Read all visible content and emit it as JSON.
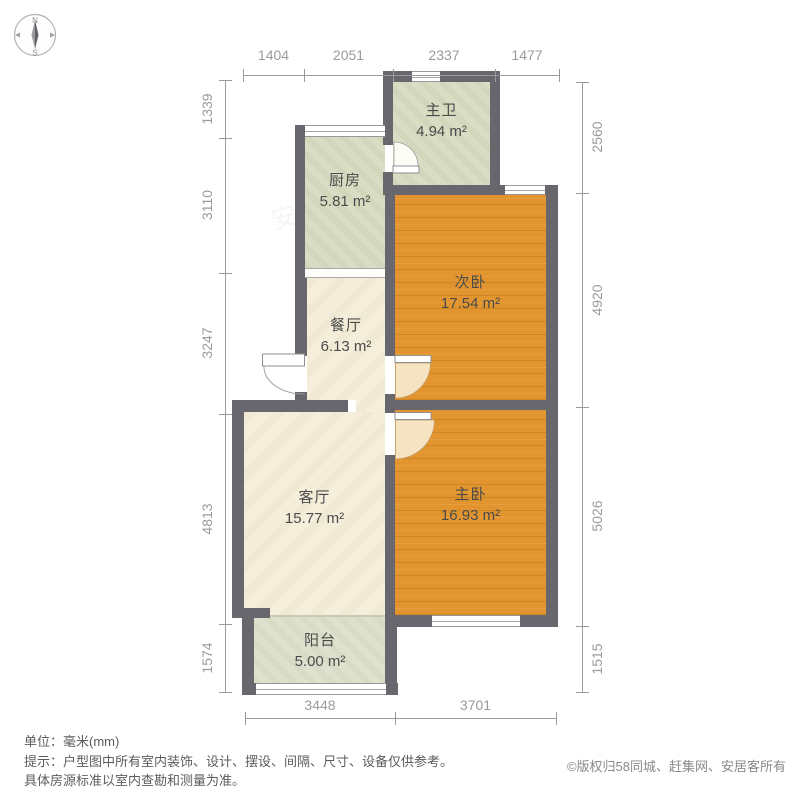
{
  "compass": {
    "north": "N",
    "south": "S"
  },
  "rooms": {
    "master_bath": {
      "name": "主卫",
      "area": "4.94 m²"
    },
    "kitchen": {
      "name": "厨房",
      "area": "5.81 m²"
    },
    "second_bedroom": {
      "name": "次卧",
      "area": "17.54 m²"
    },
    "dining": {
      "name": "餐厅",
      "area": "6.13 m²"
    },
    "living": {
      "name": "客厅",
      "area": "15.77 m²"
    },
    "master_bedroom": {
      "name": "主卧",
      "area": "16.93 m²"
    },
    "balcony": {
      "name": "阳台",
      "area": "5.00 m²"
    }
  },
  "dimensions": {
    "unit": "mm",
    "top": [
      "1404",
      "2051",
      "2337",
      "1477"
    ],
    "left": [
      "1339",
      "3110",
      "3247",
      "4813",
      "1574"
    ],
    "right": [
      "2560",
      "4920",
      "5026",
      "1515"
    ],
    "bottom": [
      "3448",
      "3701"
    ]
  },
  "footer": {
    "unit_note": "单位：毫米(mm)",
    "tip_line1": "提示：户型图中所有室内装饰、设计、摆设、间隔、尺寸、设备仅供参考。",
    "tip_line2": "具体房源标准以室内查勘和测量为准。",
    "copyright": "©版权归58同城、赶集网、安居客所有"
  },
  "watermark": {
    "text1": "安居客",
    "text2": "58同城"
  },
  "colors": {
    "wall": "#67676d",
    "tile_floor": "#d9ddc3",
    "cream_floor": "#f4eedb",
    "bedroom_floor": "#e2952e",
    "balcony_floor": "#dde1ce",
    "dim_text": "#9b9b9b"
  }
}
